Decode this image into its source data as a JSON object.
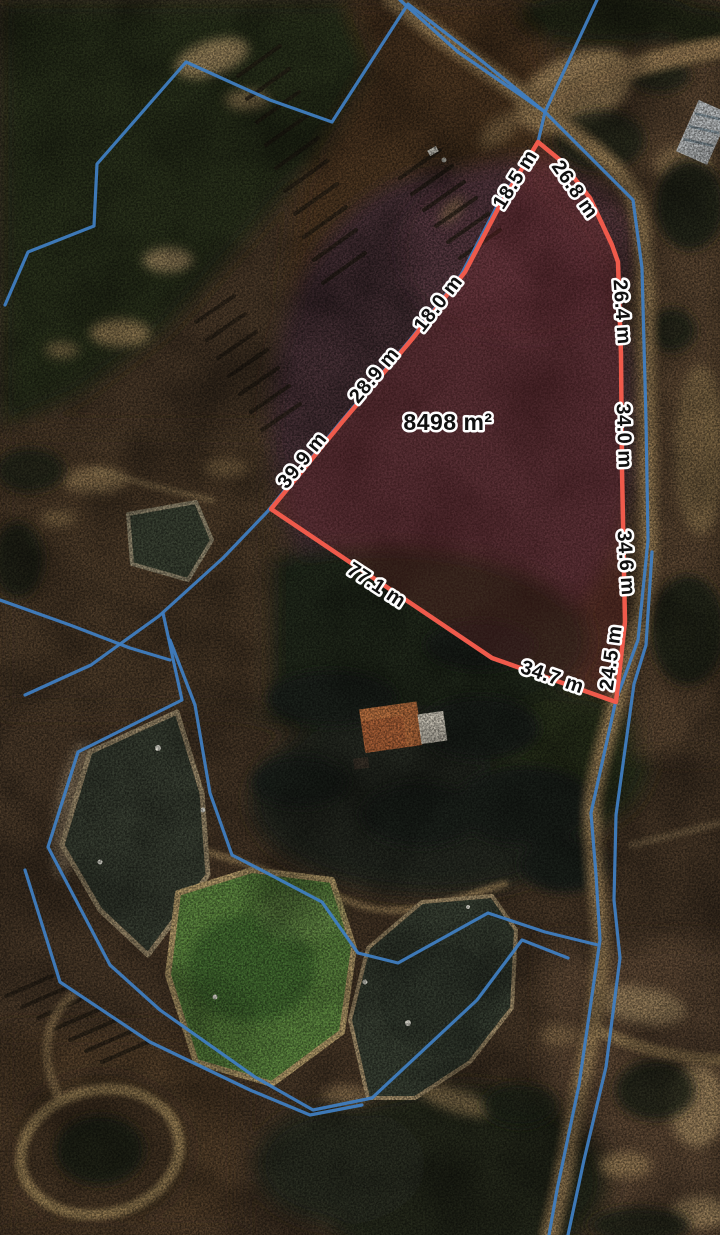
{
  "map": {
    "view_label": "satellite-measurement-view",
    "area_label": "8498 m²",
    "segment_labels": [
      {
        "label": "18.5 m",
        "x": 516,
        "y": 180,
        "rot": -58
      },
      {
        "label": "26.8 m",
        "x": 574,
        "y": 190,
        "rot": 55
      },
      {
        "label": "26.4 m",
        "x": 621,
        "y": 312,
        "rot": 86
      },
      {
        "label": "34.0 m",
        "x": 623,
        "y": 436,
        "rot": 88
      },
      {
        "label": "34.6 m",
        "x": 625,
        "y": 563,
        "rot": 86
      },
      {
        "label": "24.5 m",
        "x": 612,
        "y": 658,
        "rot": -82
      },
      {
        "label": "34.7 m",
        "x": 552,
        "y": 678,
        "rot": 19
      },
      {
        "label": "77.1 m",
        "x": 376,
        "y": 586,
        "rot": 33
      },
      {
        "label": "39.9 m",
        "x": 303,
        "y": 461,
        "rot": -51
      },
      {
        "label": "28.9 m",
        "x": 375,
        "y": 376,
        "rot": -50
      },
      {
        "label": "18.0 m",
        "x": 439,
        "y": 304,
        "rot": -52
      }
    ],
    "red_polygon": [
      [
        538,
        142
      ],
      [
        560,
        160
      ],
      [
        590,
        198
      ],
      [
        612,
        245
      ],
      [
        618,
        262
      ],
      [
        621,
        355
      ],
      [
        622,
        470
      ],
      [
        625,
        622
      ],
      [
        616,
        702
      ],
      [
        492,
        658
      ],
      [
        271,
        509
      ],
      [
        343,
        421
      ],
      [
        413,
        338
      ],
      [
        465,
        272
      ],
      [
        500,
        205
      ]
    ],
    "blue_boundaries": [
      [
        [
          5,
          305
        ],
        [
          28,
          252
        ],
        [
          94,
          226
        ],
        [
          97,
          164
        ],
        [
          186,
          62
        ],
        [
          270,
          100
        ],
        [
          332,
          122
        ],
        [
          408,
          4
        ],
        [
          478,
          58
        ],
        [
          545,
          112
        ]
      ],
      [
        [
          400,
          0
        ],
        [
          458,
          52
        ],
        [
          545,
          112
        ],
        [
          633,
          200
        ],
        [
          642,
          268
        ],
        [
          646,
          420
        ],
        [
          648,
          540
        ],
        [
          638,
          640
        ],
        [
          616,
          700
        ],
        [
          591,
          813
        ],
        [
          596,
          875
        ],
        [
          600,
          940
        ],
        [
          579,
          1085
        ],
        [
          557,
          1190
        ],
        [
          549,
          1235
        ]
      ],
      [
        [
          597,
          0
        ],
        [
          545,
          112
        ],
        [
          538,
          142
        ],
        [
          496,
          208
        ],
        [
          461,
          275
        ],
        [
          409,
          341
        ],
        [
          339,
          424
        ],
        [
          267,
          512
        ],
        [
          223,
          558
        ],
        [
          159,
          616
        ],
        [
          91,
          665
        ],
        [
          25,
          695
        ]
      ],
      [
        [
          652,
          552
        ],
        [
          646,
          645
        ],
        [
          634,
          684
        ],
        [
          616,
          815
        ],
        [
          614,
          900
        ],
        [
          620,
          958
        ],
        [
          606,
          1067
        ],
        [
          584,
          1160
        ],
        [
          568,
          1235
        ]
      ],
      [
        [
          163,
          613
        ],
        [
          182,
          700
        ],
        [
          78,
          752
        ],
        [
          48,
          847
        ],
        [
          110,
          965
        ],
        [
          160,
          1010
        ],
        [
          255,
          1077
        ],
        [
          313,
          1110
        ],
        [
          372,
          1098
        ],
        [
          477,
          1000
        ],
        [
          522,
          940
        ],
        [
          568,
          958
        ]
      ],
      [
        [
          170,
          640
        ],
        [
          195,
          705
        ],
        [
          210,
          793
        ],
        [
          232,
          855
        ],
        [
          265,
          872
        ],
        [
          322,
          902
        ],
        [
          358,
          953
        ],
        [
          398,
          963
        ],
        [
          488,
          913
        ],
        [
          545,
          932
        ],
        [
          598,
          945
        ]
      ],
      [
        [
          25,
          870
        ],
        [
          60,
          982
        ],
        [
          150,
          1042
        ],
        [
          250,
          1090
        ],
        [
          310,
          1115
        ],
        [
          362,
          1105
        ]
      ],
      [
        [
          0,
          600
        ],
        [
          70,
          625
        ],
        [
          130,
          648
        ],
        [
          170,
          660
        ]
      ]
    ],
    "colors": {
      "measure_line": "#ef5a4b",
      "measure_fill": "rgba(150,45,50,0.22)",
      "boundary_line": "#3f7dc0",
      "label_text": "#101010",
      "label_halo": "#ffffff"
    }
  }
}
